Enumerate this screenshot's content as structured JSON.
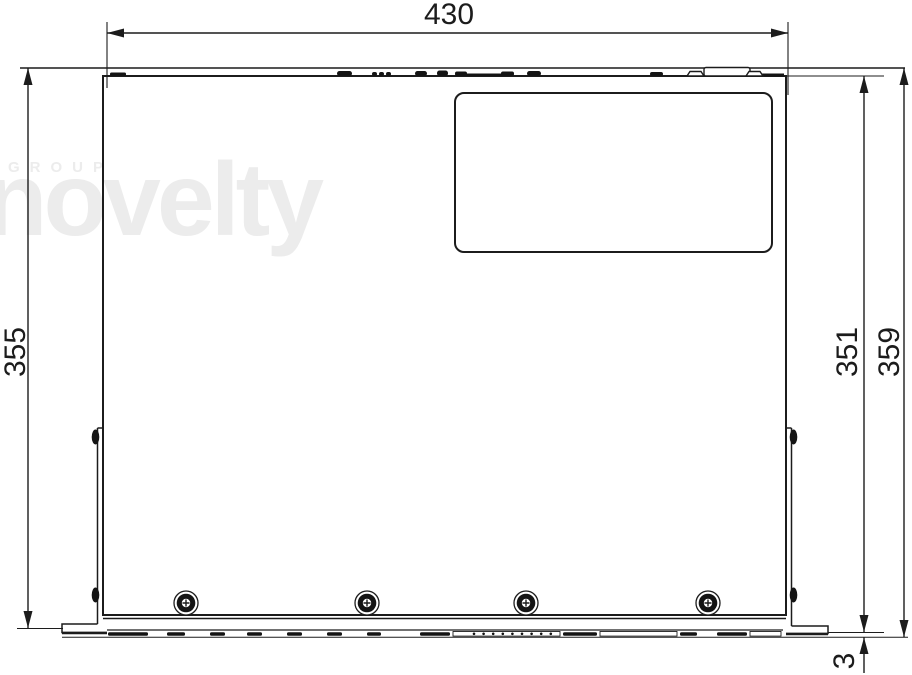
{
  "drawing": {
    "type": "technical-dimension-drawing",
    "view": "top view of rack-mount chassis"
  },
  "dimensions": {
    "width": "430",
    "depth_left": "355",
    "depth_right_inner": "351",
    "depth_right_outer": "359",
    "front_offset": "3"
  },
  "watermark": {
    "group": "GROUP",
    "brand": "novelty"
  },
  "colors": {
    "line": "#1c1c1c",
    "watermark": "#ececec",
    "background": "#ffffff"
  }
}
